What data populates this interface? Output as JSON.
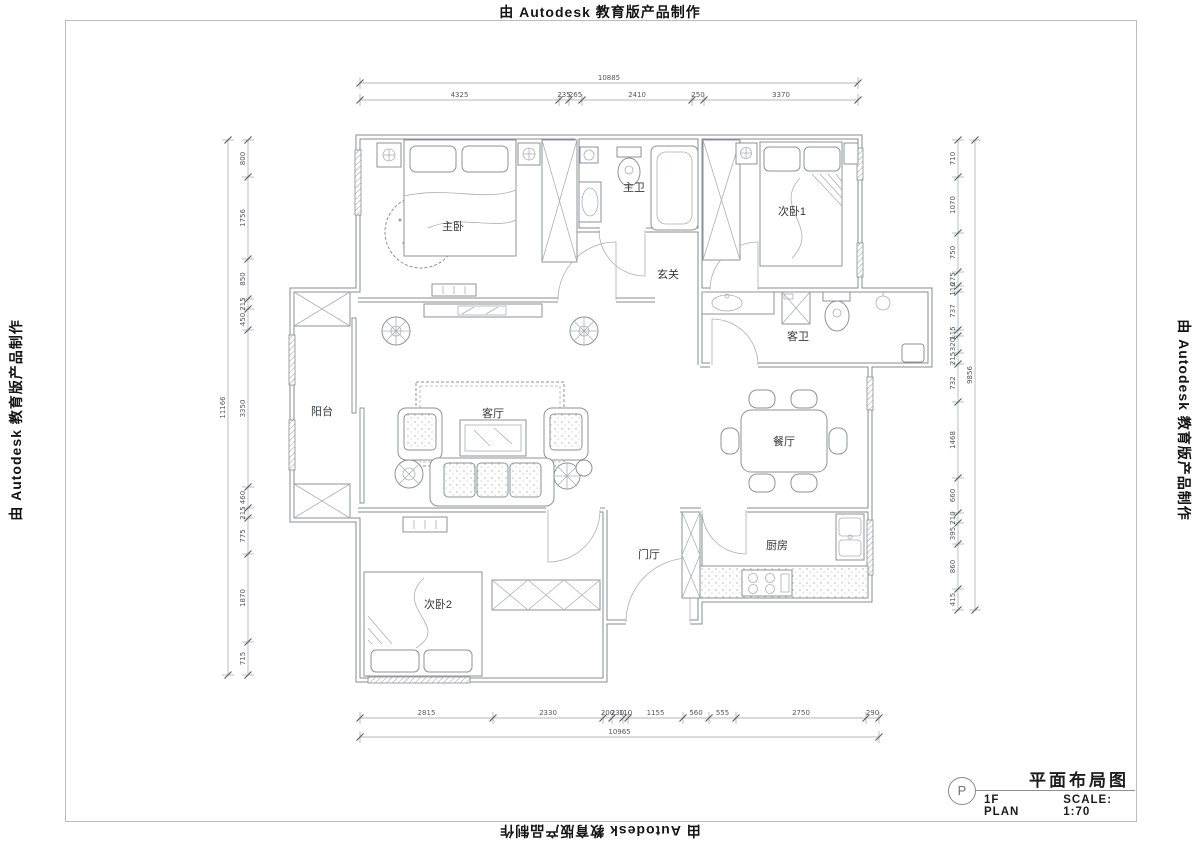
{
  "watermark": {
    "text": "由 Autodesk 教育版产品制作"
  },
  "title_block": {
    "symbol": "P",
    "title": "平面布局图",
    "plan_name": "1F PLAN",
    "scale": "SCALE: 1:70"
  },
  "rooms": {
    "master_bedroom": "主卧",
    "master_bath": "主卫",
    "bedroom2": "次卧1",
    "entry_hall": "玄关",
    "guest_bath": "客卫",
    "balcony": "阳台",
    "living_room": "客厅",
    "dining_room": "餐厅",
    "foyer": "门厅",
    "kitchen": "厨房",
    "bedroom3": "次卧2"
  },
  "dimensions": {
    "top_total": "10885",
    "top": [
      "4325",
      "235",
      "265",
      "2410",
      "250",
      "3370"
    ],
    "bottom_total": "10965",
    "bottom": [
      "2815",
      "2330",
      "200",
      "230",
      "110",
      "1155",
      "560",
      "555",
      "2750",
      "290"
    ],
    "left_total": "11166",
    "left": [
      "800",
      "1756",
      "850",
      "215",
      "450",
      "3350",
      "460",
      "215",
      "775",
      "1870",
      "715"
    ],
    "right_total": "9856",
    "right": [
      "710",
      "1070",
      "750",
      "275",
      "116",
      "737",
      "115",
      "320",
      "215",
      "732",
      "1468",
      "660",
      "210",
      "395",
      "860",
      "415"
    ]
  },
  "colors": {
    "line": "#878d93",
    "text": "#1c1c1c",
    "dim_text": "#55595e"
  }
}
